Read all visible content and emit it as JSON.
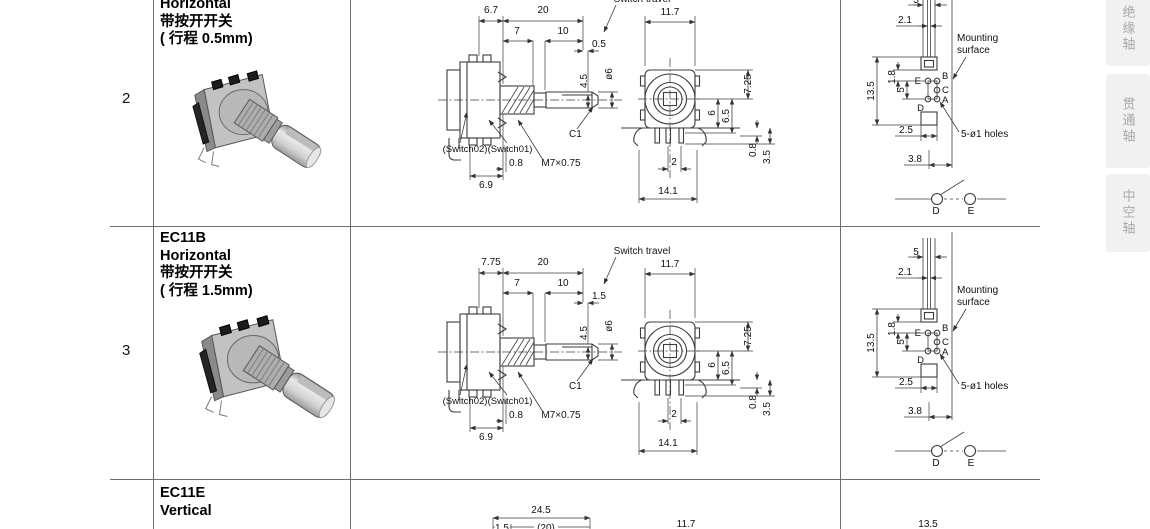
{
  "sidebar": {
    "tabs": [
      {
        "label": "绝缘轴"
      },
      {
        "label": "贯通轴"
      },
      {
        "label": "中空轴"
      }
    ]
  },
  "rows": {
    "r2": {
      "number": "2",
      "title_lines": [
        "Horizontal",
        "带按开开关",
        "( 行程 0.5mm)"
      ],
      "side": {
        "d_bush": "6.7",
        "d_total": "20",
        "d_thread": "7",
        "d_shaft": "10",
        "d_travel": "0.5",
        "d_flat": "4.5",
        "d_dia": "ø6",
        "chamfer": "C1",
        "sw2": "(Switch02)",
        "sw1": "(Switch01)",
        "d_pin": "0.8",
        "thread_spec": "M7×0.75",
        "d_body": "6.9",
        "travel_label": "Switch travel"
      },
      "front": {
        "d_top": "11.7",
        "d_h": "7.25",
        "d_c": "6",
        "d_c2": "6.5",
        "d_p": "0.8",
        "d_p2": "3.5",
        "d_pitch": "2",
        "d_bot": "14.1"
      },
      "mount": {
        "d_w": "5",
        "d_inner": "2.1",
        "surf1": "Mounting",
        "surf2": "surface",
        "d_span": "13.5",
        "d_off": "1.8",
        "d_pitch": "5",
        "pin_e": "E",
        "pin_b": "B",
        "pin_c": "C",
        "pin_a": "A",
        "pin_d": "D",
        "d_b1": "2.5",
        "holes": "5-ø1 holes",
        "d_b2": "3.8",
        "sw_d": "D",
        "sw_e": "E"
      }
    },
    "r3": {
      "number": "3",
      "title_lines": [
        "EC11B",
        "Horizontal",
        "带按开开关",
        "( 行程 1.5mm)"
      ],
      "side": {
        "d_bush": "7.75",
        "d_total": "20",
        "d_thread": "7",
        "d_shaft": "10",
        "d_travel": "1.5",
        "d_flat": "4.5",
        "d_dia": "ø6",
        "chamfer": "C1",
        "sw2": "(Switch02)",
        "sw1": "(Switch01)",
        "d_pin": "0.8",
        "thread_spec": "M7×0.75",
        "d_body": "6.9",
        "travel_label": "Switch travel"
      },
      "front": {
        "d_top": "11.7",
        "d_h": "7.25",
        "d_c": "6",
        "d_c2": "6.5",
        "d_p": "0.8",
        "d_p2": "3.5",
        "d_pitch": "2",
        "d_bot": "14.1"
      },
      "mount": {
        "d_w": "5",
        "d_inner": "2.1",
        "surf1": "Mounting",
        "surf2": "surface",
        "d_span": "13.5",
        "d_off": "1.8",
        "d_pitch": "5",
        "pin_e": "E",
        "pin_b": "B",
        "pin_c": "C",
        "pin_a": "A",
        "pin_d": "D",
        "d_b1": "2.5",
        "holes": "5-ø1 holes",
        "d_b2": "3.8",
        "sw_d": "D",
        "sw_e": "E"
      }
    },
    "r4": {
      "title_lines": [
        "EC11E",
        "Vertical"
      ],
      "d_top": "24.5",
      "d_s1": "1.5",
      "d_s2": "(20)",
      "d_s3": "11.7",
      "d_s4": "13.5"
    }
  }
}
